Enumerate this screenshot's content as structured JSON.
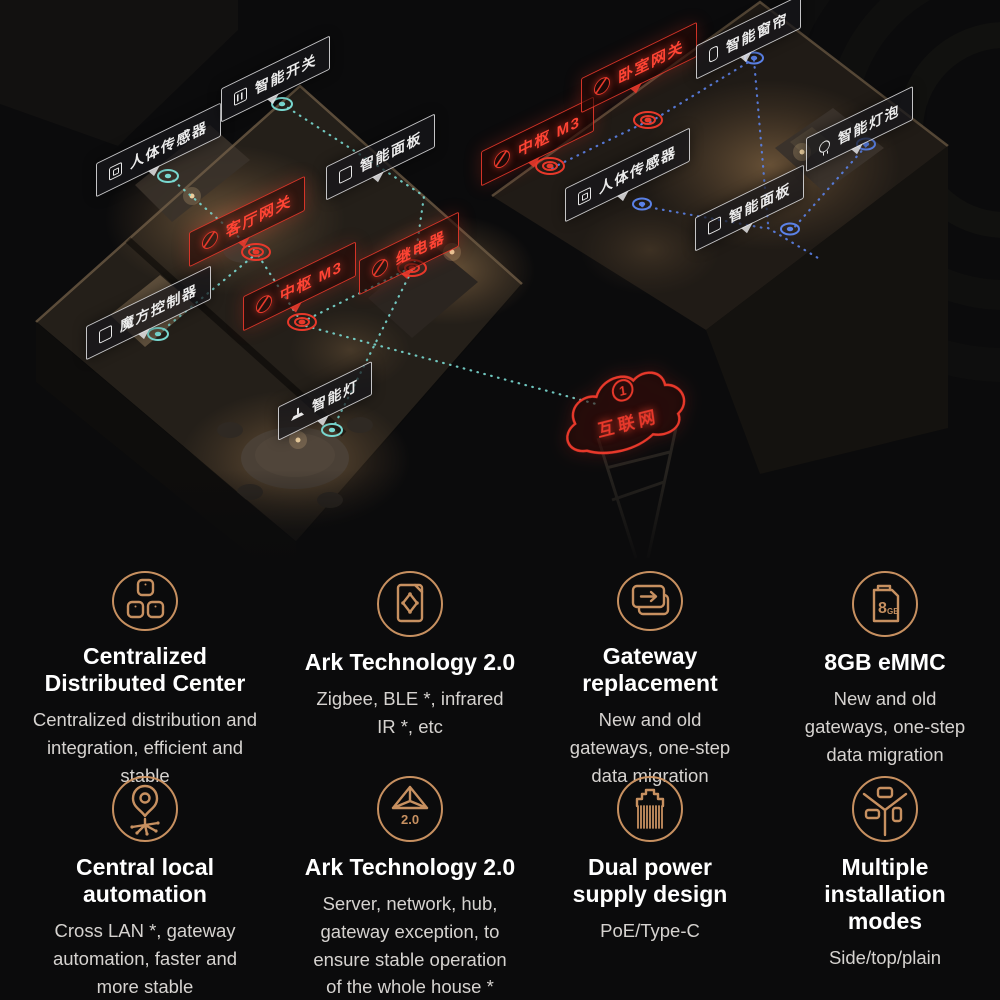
{
  "colors": {
    "bg": "#0b0b0c",
    "accent": "#c79060",
    "red": "#e8392b",
    "teal": "#79d8d0",
    "blue": "#5b82e8",
    "title": "#ffffff",
    "subtext": "#d6d3d0"
  },
  "scene": {
    "cloud": {
      "badge": "1",
      "label": "互联网"
    },
    "labels": {
      "human_sensor_left": "人体传感器",
      "smart_switch": "智能开关",
      "smart_panel_left": "智能面板",
      "cube_controller": "魔方控制器",
      "smart_light": "智能灯",
      "living_room_gateway": "客厅网关",
      "hub_m3_left": "中枢 M3",
      "relay": "继电器",
      "hub_m3_right": "中枢 M3",
      "bedroom_gateway": "卧室网关",
      "smart_curtain": "智能窗帘",
      "human_sensor_right": "人体传感器",
      "smart_panel_right": "智能面板",
      "smart_bulb": "智能灯泡"
    }
  },
  "features": {
    "items": [
      {
        "icon": "blocks-icon",
        "title": "Centralized\nDistributed Center",
        "desc": "Centralized distribution and\nintegration, efficient and\nstable"
      },
      {
        "icon": "ark-document-icon",
        "title": "Ark Technology 2.0",
        "desc": "Zigbee, BLE *, infrared\nIR *, etc"
      },
      {
        "icon": "card-stack-icon",
        "title": "Gateway\nreplacement",
        "desc": "New and old\ngateways, one-step\ndata migration"
      },
      {
        "icon": "memory-card-icon",
        "title": "8GB eMMC",
        "desc": "New and old\ngateways, one-step\ndata migration",
        "icon_text_big": "8",
        "icon_text_small": "GB"
      },
      {
        "icon": "pin-network-icon",
        "title": "Central local\nautomation",
        "desc": "Cross LAN *, gateway\nautomation, faster and\nmore stable"
      },
      {
        "icon": "pyramid-icon",
        "title": "Ark Technology 2.0",
        "desc": "Server, network, hub,\ngateway exception, to\nensure stable operation\nof the whole house *",
        "icon_text": "2.0"
      },
      {
        "icon": "power-connector-icon",
        "title": "Dual power\nsupply design",
        "desc": "PoE/Type-C"
      },
      {
        "icon": "install-modes-icon",
        "title": "Multiple installation\nmodes",
        "desc": "Side/top/plain"
      }
    ]
  }
}
